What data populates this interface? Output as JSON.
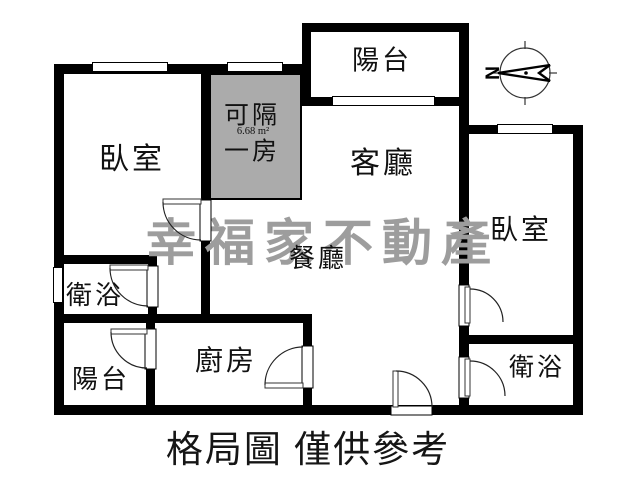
{
  "floorplan": {
    "rooms": {
      "bedroom_left": {
        "label": "臥室"
      },
      "partition": {
        "line1": "可隔",
        "line2": "一房",
        "area": "6.68 m²"
      },
      "balcony_top": {
        "label": "陽台"
      },
      "living": {
        "label": "客廳"
      },
      "dining": {
        "label": "餐廳"
      },
      "bedroom_right": {
        "label": "臥室"
      },
      "bath_left": {
        "label": "衛浴"
      },
      "balcony_bottom": {
        "label": "陽台"
      },
      "kitchen": {
        "label": "廚房"
      },
      "bath_right": {
        "label": "衛浴"
      }
    },
    "compass": {
      "label": "N"
    },
    "watermark": {
      "text": "幸福家不動產",
      "color": "#9d9d9d"
    },
    "caption": "格局圖 僅供參考",
    "colors": {
      "wall": "#000000",
      "partition_fill": "#ababab",
      "background": "#ffffff"
    }
  }
}
